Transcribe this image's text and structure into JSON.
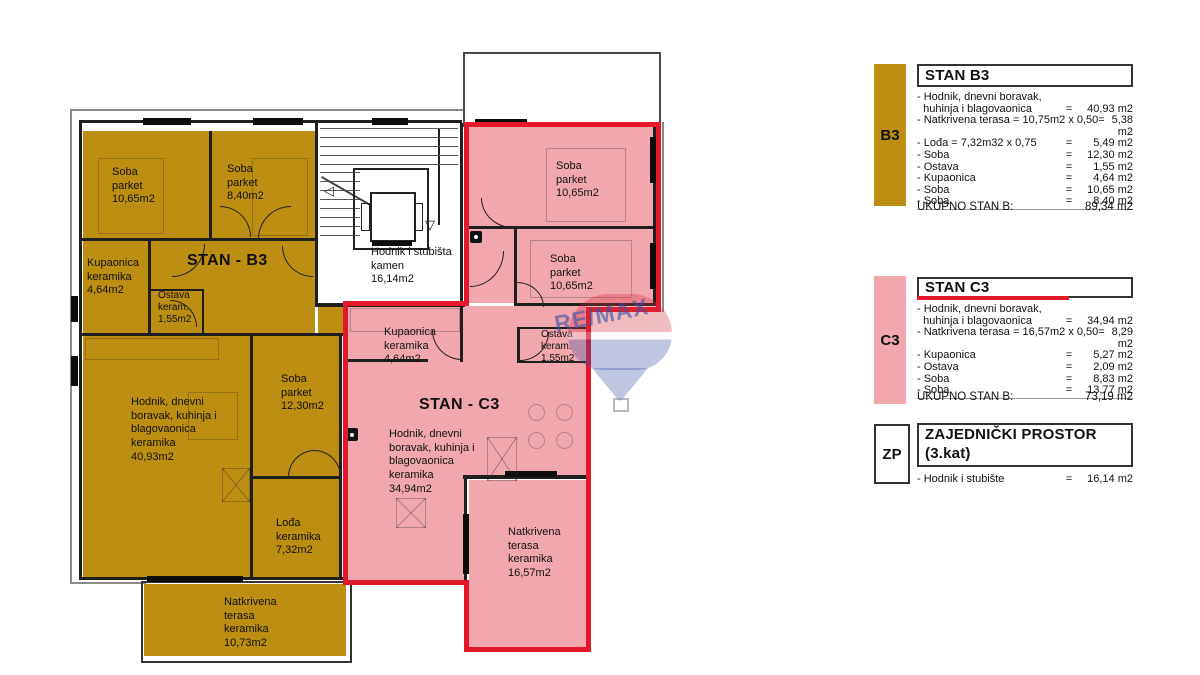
{
  "plan": {
    "b3": {
      "title": "STAN - B3",
      "room1": "Soba\nparket\n10,65m2",
      "room2": "Soba\nparket\n8,40m2",
      "bath": "Kupaonica\nkeramika\n4,64m2",
      "storage": "Ostava\nkeram.\n1,55m2",
      "living": "Hodnik, dnevni\nboravak, kuhinja i\nblagovaonica\nkeramika\n40,93m2",
      "room3": "Soba\nparket\n12,30m2",
      "loggia": "Lođa\nkeramika\n7,32m2",
      "terrace": "Natkrivena\nterasa\nkeramika\n10,73m2"
    },
    "c3": {
      "title": "STAN - C3",
      "room1": "Soba\nparket\n10,65m2",
      "room2": "Soba\nparket\n10,65m2",
      "bath": "Kupaonica\nkeramika\n4,64m2",
      "storage": "Ostava\nkeram.\n1,55m2",
      "living": "Hodnik, dnevni\nboravak, kuhinja i\nblagovaonica\nkeramika\n34,94m2",
      "terrace": "Natkrivena\nterasa\nkeramika\n16,57m2"
    },
    "stairwell": "Hodnik i stubišta\nkamen\n16,14m2"
  },
  "legend": {
    "b3": {
      "code": "B3",
      "title": "STAN B3",
      "items": [
        {
          "text": "- Hodnik, dnevni boravak,",
          "eq": "",
          "value": ""
        },
        {
          "text": "  huhinja i blagovaonica",
          "eq": "=",
          "value": "40,93 m2"
        },
        {
          "text": "- Natkrivena terasa = 10,75m2 x 0,50",
          "eq": "=",
          "value": "5,38 m2"
        },
        {
          "text": "- Lođa = 7,32m32 x 0,75",
          "eq": "=",
          "value": "5,49 m2"
        },
        {
          "text": "- Soba",
          "eq": "=",
          "value": "12,30 m2"
        },
        {
          "text": "- Ostava",
          "eq": "=",
          "value": "1,55 m2"
        },
        {
          "text": "- Kupaonica",
          "eq": "=",
          "value": "4,64 m2"
        },
        {
          "text": "- Soba",
          "eq": "=",
          "value": "10,65 m2"
        },
        {
          "text": "- Soba",
          "eq": "=",
          "value": "8,40 m2"
        }
      ],
      "total_label": "UKUPNO STAN B:",
      "total_value": "89,34 m2"
    },
    "c3": {
      "code": "C3",
      "title": "STAN C3",
      "items": [
        {
          "text": "- Hodnik, dnevni boravak,",
          "eq": "",
          "value": ""
        },
        {
          "text": "  huhinja i blagovaonica",
          "eq": "=",
          "value": "34,94 m2"
        },
        {
          "text": "- Natkrivena terasa = 16,57m2 x 0,50",
          "eq": "=",
          "value": "8,29 m2"
        },
        {
          "text": "- Kupaonica",
          "eq": "=",
          "value": "5,27 m2"
        },
        {
          "text": "- Ostava",
          "eq": "=",
          "value": "2,09 m2"
        },
        {
          "text": "- Soba",
          "eq": "=",
          "value": "8,83 m2"
        },
        {
          "text": "- Soba",
          "eq": "=",
          "value": "13,77 m2"
        }
      ],
      "total_label": "UKUPNO STAN B:",
      "total_value": "73,19 m2"
    },
    "zp": {
      "code": "ZP",
      "title_line1": "ZAJEDNIČKI PROSTOR",
      "title_line2": "(3.kat)",
      "item": {
        "text": "- Hodnik i stubište",
        "eq": "=",
        "value": "16,14 m2"
      }
    }
  },
  "watermark": {
    "text": "RE/MAX"
  },
  "colors": {
    "b3_gold": "#BE8E12",
    "c3_pink": "#F2A6AE",
    "boundary_red": "#E4182B"
  }
}
